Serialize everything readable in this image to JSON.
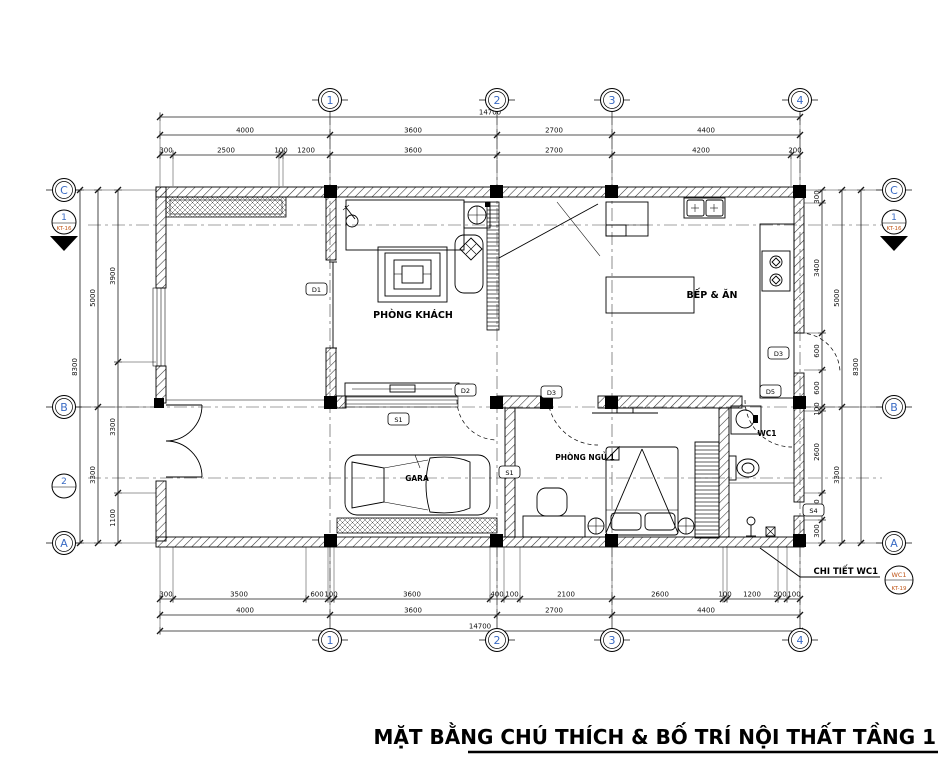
{
  "title": "MẶT BẰNG CHÚ THÍCH & BỐ TRÍ NỘI THẤT TẦNG 1",
  "grid": {
    "columns": [
      "1",
      "2",
      "3",
      "4"
    ],
    "rows": [
      "C",
      "B",
      "A"
    ]
  },
  "section_markers": {
    "top": {
      "number": "1",
      "sheet": "KT-16"
    },
    "bottom": {
      "number": "2",
      "sheet": "KT-17"
    }
  },
  "callout": {
    "label": "CHI TIẾT WC1",
    "detail_code": "WC1",
    "sheet": "KT-19"
  },
  "rooms": {
    "living": {
      "name": "PHÒNG KHÁCH",
      "level": "±0.000"
    },
    "kitchen": {
      "name": "BẾP & ĂN",
      "level": "±0.000"
    },
    "garage": {
      "name": "GARA",
      "level": "-0.050"
    },
    "bedroom": {
      "name": "PHÒNG NGỦ 1",
      "level": "±0.000"
    },
    "wc": {
      "name": "WC1",
      "level": "-0.020"
    },
    "shower_level": "-0.030",
    "porch_level": "-0.050",
    "yard_level": "-0.150"
  },
  "tags": {
    "d1": "D1",
    "d2": "D2",
    "d3": "D3",
    "d5": "D5",
    "s1": "S1",
    "s4": "S4"
  },
  "dimensions": {
    "top_total": "14700",
    "top_segments": [
      "4000",
      "3600",
      "2700",
      "4400"
    ],
    "top_detail": [
      "300",
      "2500",
      "100",
      "1200",
      "3600",
      "2700",
      "4200",
      "200"
    ],
    "bottom_detail": [
      "300",
      "3500",
      "600",
      "100",
      "3600",
      "400",
      "100",
      "2100",
      "2600",
      "100",
      "1200",
      "200",
      "100"
    ],
    "bottom_segments": [
      "4000",
      "3600",
      "2700",
      "4400"
    ],
    "bottom_total": "14700",
    "left_total": "8300",
    "left_segments": [
      "5000",
      "3300"
    ],
    "left_detail": [
      "3900",
      "3300",
      "1100"
    ],
    "right_detail": [
      "300",
      "3400",
      "600",
      "600",
      "100",
      "2600",
      "400",
      "300"
    ],
    "right_segments": [
      "5000",
      "3300"
    ],
    "right_total": "8300"
  },
  "colors": {
    "grid_bubble_text": "#3a6bc4",
    "section_ref_text": "#c0571a",
    "line": "#000000",
    "background": "#ffffff"
  }
}
